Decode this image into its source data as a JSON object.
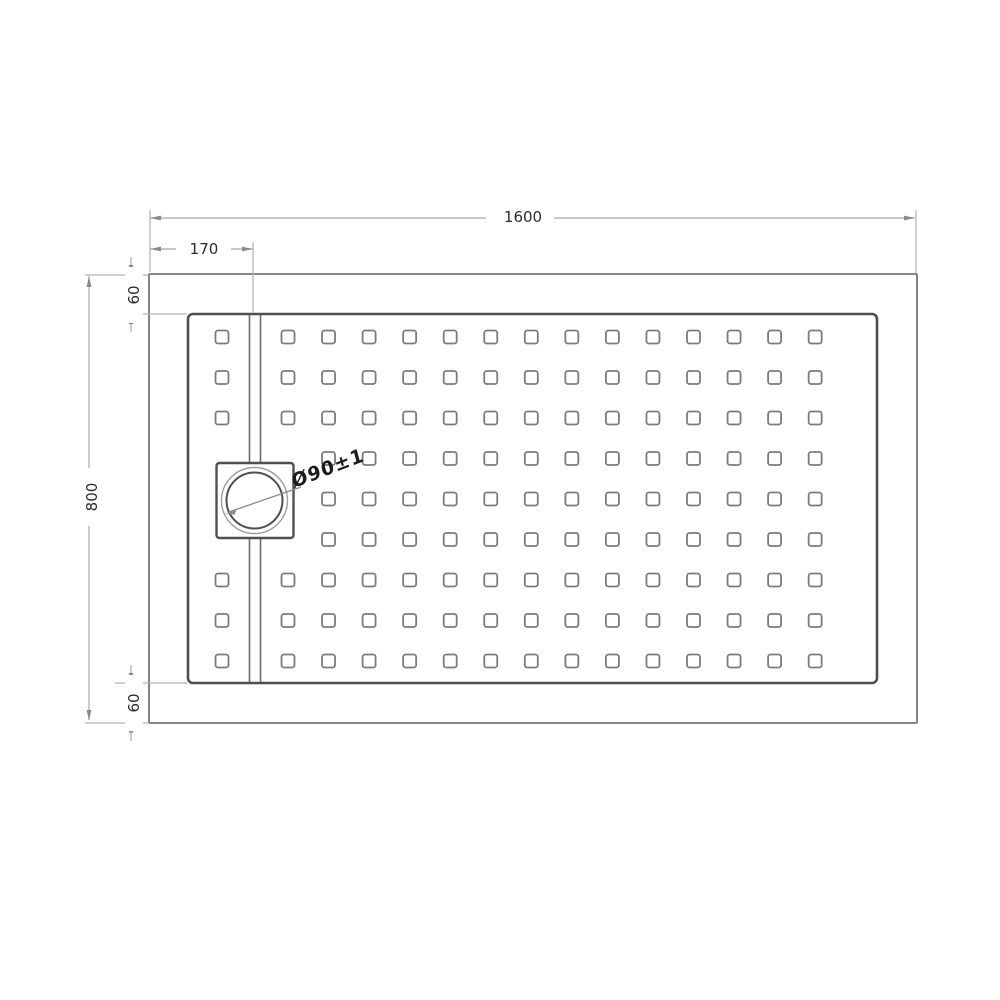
{
  "drawing": {
    "title": "shower-tray-plan-technical-drawing",
    "labels": {
      "overall_width": "1600",
      "drain_offset": "170",
      "overall_depth": "800",
      "rim_top": "60",
      "rim_bottom": "60",
      "drain_diameter": "Ø90±1"
    },
    "colors": {
      "background": "#ffffff",
      "outer_outline": "#777777",
      "inner_outline": "#4f4f4f",
      "hole_outline": "#7b7b7b",
      "channel_outline": "#6b6b6b",
      "circle_outer": "#9d9d9d",
      "circle_inner": "#4f4f4f",
      "dimension_line": "#b0b0b0",
      "arrow": "#8a8a8a",
      "dimension_text": "#2b2b2b"
    },
    "pattern": {
      "rows": 9,
      "main_columns": 14,
      "has_left_column": true,
      "left_column_missing_rows": [
        3,
        4,
        5
      ],
      "first_main_column_missing_rows": [
        3,
        4,
        5
      ],
      "total_holes": 129
    }
  }
}
